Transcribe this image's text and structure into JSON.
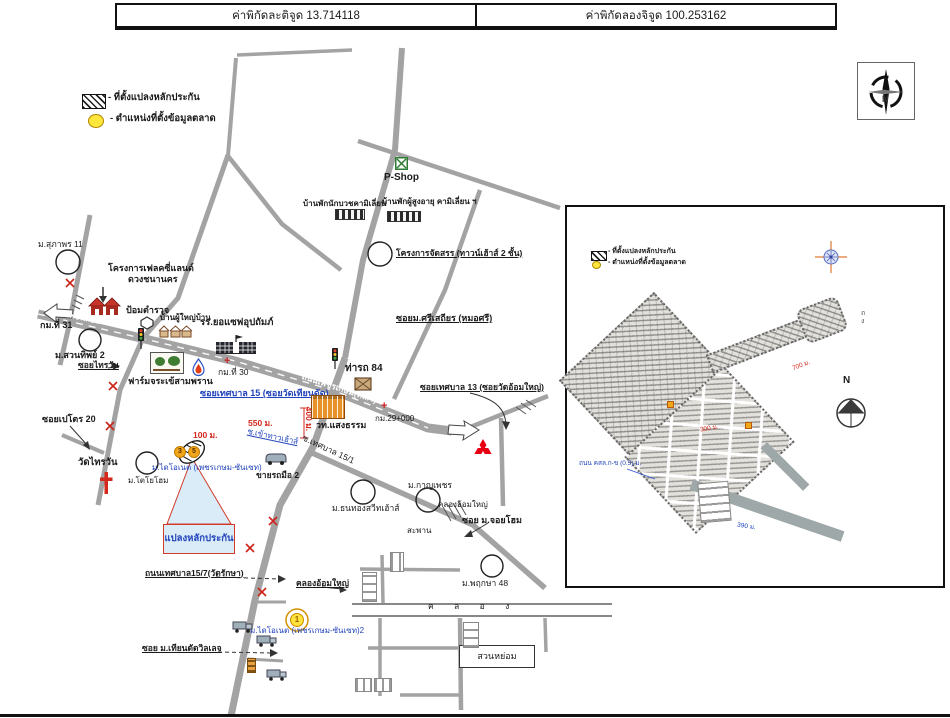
{
  "header": {
    "lat": "ค่าพิกัดละติจูด 13.714118",
    "lng": "ค่าพิกัดลองจิจูด 100.253162"
  },
  "legend": {
    "plot": "- ที่ตั้งแปลงหลักประกัน",
    "market": "- ตำแหน่งที่ตั้งข้อมูลตลาด"
  },
  "compass": {
    "n": "N"
  },
  "main_map": {
    "road_labels": {
      "phetkasem": "ถนนเพชรเกษม(ทล.4)",
      "phetkasem_left": "ถนนเพชรเกษม"
    },
    "markers": {
      "shield_left": "3",
      "shield_right": "5",
      "market_point": "1"
    },
    "labels": [
      {
        "text": "ม.สุภาพร 11"
      },
      {
        "text": "โครงการเฟลคซี่แลนด์"
      },
      {
        "text": "ดวงชนานคร"
      },
      {
        "text": "P-Shop"
      },
      {
        "text": "บ้านพักนักบวชคามิเลี่ยน"
      },
      {
        "text": "บ้านพักผู้สูงอายุ คามิเลี่ยน ฯ"
      },
      {
        "text": "โครงการจัดสรร (ทาวน์เฮ้าส์ 2 ชั้น)"
      },
      {
        "text": "กม.ที่ 31"
      },
      {
        "text": "ม.สวนทิพย์ 2"
      },
      {
        "text": "ซอยไทรวัน"
      },
      {
        "text": "ป้อมตำรวจ"
      },
      {
        "text": "บ้านผู้ใหญ่บ้าน"
      },
      {
        "text": "รร.ยอแซฟอุปถัมภ์"
      },
      {
        "text": "ฟาร์มจระเข้สามพราน"
      },
      {
        "text": "กม.ที่ 30"
      },
      {
        "text": "ท่ารถ 84"
      },
      {
        "text": "ซอยม.ศรีเสถียร (หมอศรี)"
      },
      {
        "text": "ซอยเทศบาล 13 (ซอยวัดอ้อมใหญ่)"
      },
      {
        "text": "กม.29+000"
      },
      {
        "text": "วท.แสงธรรม"
      },
      {
        "text": "ซอยเทศบาล 15 (ซอยวัดเทียนดัด)"
      },
      {
        "text": "550 ม."
      },
      {
        "text": "100 ม."
      },
      {
        "text": "400 ม."
      },
      {
        "text": "ซ.เข้าทาวเฮ้าส์"
      },
      {
        "text": "ม.ไดโอเนต (เพชรเกษม-ซันเซท)"
      },
      {
        "text": "ม.โตโยโฮม"
      },
      {
        "text": "ขายรถมือ 2"
      },
      {
        "text": "ซ.เทศบาล 15/1"
      },
      {
        "text": "ซอยเปโตร 20"
      },
      {
        "text": "วัดไทรวัน"
      },
      {
        "text": "แปลงหลักประกัน"
      },
      {
        "text": "ถนนเทศบาล15/7(วัดรักษา)"
      },
      {
        "text": "คลองอ้อมใหญ่"
      },
      {
        "text": "ม.ธนทองสวีทเฮ้าส์"
      },
      {
        "text": "ม.กาญเพชร"
      },
      {
        "text": "คลองอ้อมใหญ่"
      },
      {
        "text": "สะพาน"
      },
      {
        "text": "ซอย ม.จอยโฮม"
      },
      {
        "text": "ม.พฤกษา 48"
      },
      {
        "text": "สวนหย่อม"
      },
      {
        "text": "ค ล อ ง"
      },
      {
        "text": "ซอย ม.เทียนดัดวิลเลจ"
      },
      {
        "text": "ม.ไดโอเนต (เพชรเกษม-ซันเซท)2"
      }
    ]
  },
  "inset": {
    "legend_plot": "- ที่ตั้งแปลงหลักประกัน",
    "legend_market": "- ตำแหน่งที่ตั้งข้อมูลตลาด",
    "side_text": "ถ\nง",
    "dist_arm": "700 ม.",
    "dist_mid": "300 ม.",
    "road_label": "ถนน คสล.ก-ข (0.5) ม.",
    "dist_bottom": "390 ม.",
    "north": "N"
  },
  "colors": {
    "road_gray": "#a3a3a3",
    "blue_text": "#2244bb",
    "red_text": "#d42a1e",
    "yellow_marker": "#ffe23c",
    "callout_fill": "#d9ecf8",
    "callout_border": "#d23b2a",
    "shield_orange": "#f2a71b"
  },
  "icons": {
    "compass-rose-icon": "4-point star in circle",
    "crosshair-compass-icon": "blue circle with orange cross",
    "north-arrow-icon": "circle with filled triangle",
    "traffic-light-icon": "black signal with 3 dots",
    "church-cross-icon": "red latin cross",
    "pshop-icon": "green crossed square",
    "gas-station-icon": "blue flame drop",
    "picture-frame-icon": "framed trees",
    "school-icon": "dark buildings with flag",
    "college-icon": "orange building",
    "bus-depot-icon": "brown crate",
    "police-box-icon": "hexagon outline",
    "red-houses-icon": "two red houses",
    "village-house-icon": "house sketch",
    "mitsubishi-logo-icon": "three red diamonds",
    "truck-icon": "gray truck",
    "van-icon": "gray van",
    "sign-icon": "orange signpost",
    "left-arrow-icon": "white outline arrow left",
    "right-arrow-icon": "white outline arrow right",
    "plot-hatch-icon": "hatched ellipse",
    "market-marker-icon": "yellow circled point"
  }
}
